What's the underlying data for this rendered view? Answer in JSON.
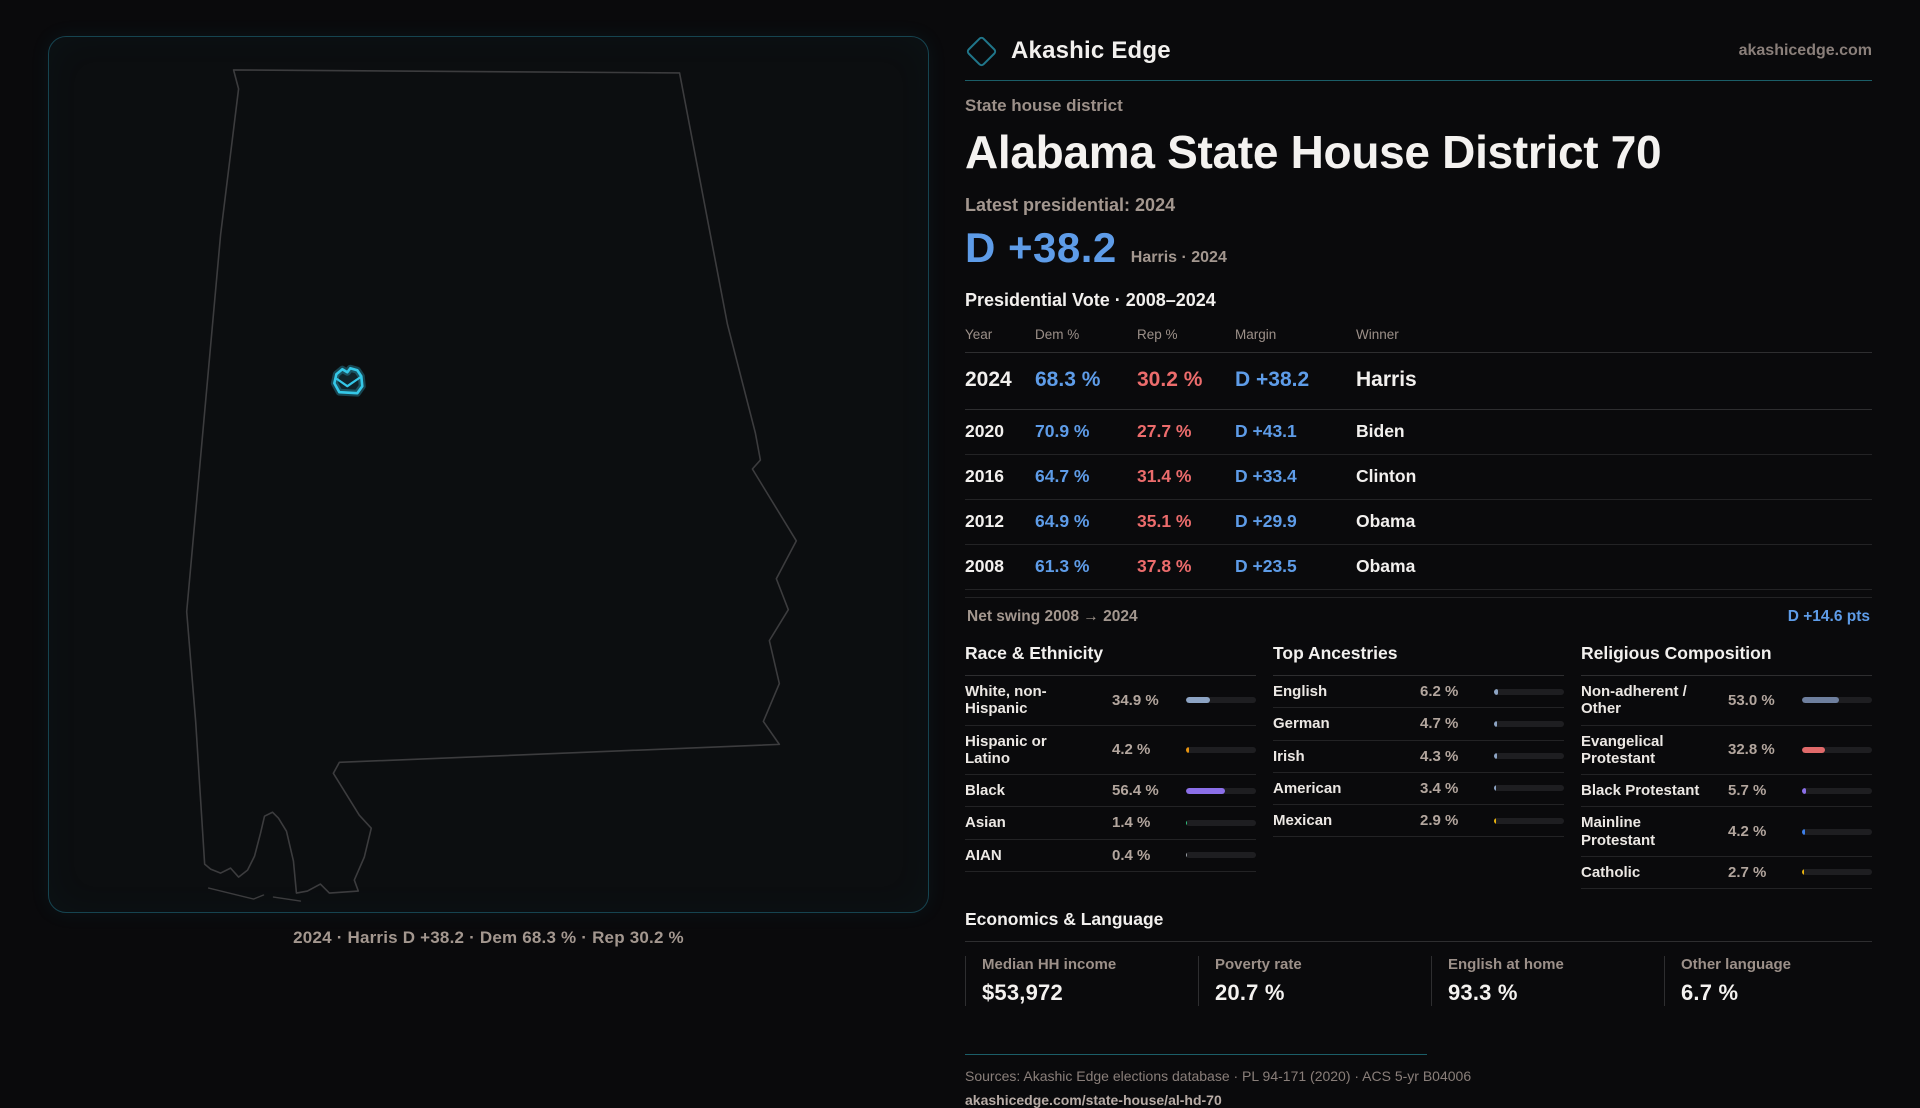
{
  "brand": {
    "name": "Akashic Edge",
    "domain": "akashicedge.com"
  },
  "page": {
    "kicker": "State house district",
    "title": "Alabama State House District 70",
    "latest_label": "Latest presidential: 2024",
    "margin_value": "D +38.2",
    "margin_detail": "Harris · 2024"
  },
  "map": {
    "caption": "2024 · Harris D +38.2 · Dem 68.3 % · Rep 30.2 %",
    "accent_color": "#35c8e8"
  },
  "pres_table": {
    "title": "Presidential Vote · 2008–2024",
    "columns": {
      "year": "Year",
      "dem": "Dem %",
      "rep": "Rep %",
      "margin": "Margin",
      "winner": "Winner"
    },
    "rows": [
      {
        "year": "2024",
        "dem": "68.3 %",
        "rep": "30.2 %",
        "margin": "D +38.2",
        "winner": "Harris"
      },
      {
        "year": "2020",
        "dem": "70.9 %",
        "rep": "27.7 %",
        "margin": "D +43.1",
        "winner": "Biden"
      },
      {
        "year": "2016",
        "dem": "64.7 %",
        "rep": "31.4 %",
        "margin": "D +33.4",
        "winner": "Clinton"
      },
      {
        "year": "2012",
        "dem": "64.9 %",
        "rep": "35.1 %",
        "margin": "D +29.9",
        "winner": "Obama"
      },
      {
        "year": "2008",
        "dem": "61.3 %",
        "rep": "37.8 %",
        "margin": "D +23.5",
        "winner": "Obama"
      }
    ],
    "net_swing_label": "Net swing 2008 → 2024",
    "net_swing_value": "D +14.6 pts"
  },
  "race": {
    "title": "Race & Ethnicity",
    "rows": [
      {
        "label": "White, non-Hispanic",
        "value": "34.9 %",
        "pct": 34.9,
        "color": "#8da4c4"
      },
      {
        "label": "Hispanic or Latino",
        "value": "4.2 %",
        "pct": 4.2,
        "color": "#e8940f"
      },
      {
        "label": "Black",
        "value": "56.4 %",
        "pct": 56.4,
        "color": "#8b6fe8"
      },
      {
        "label": "Asian",
        "value": "1.4 %",
        "pct": 1.4,
        "color": "#2ec27e"
      },
      {
        "label": "AIAN",
        "value": "0.4 %",
        "pct": 0.4,
        "color": "#9aa0a6"
      }
    ]
  },
  "ancestries": {
    "title": "Top Ancestries",
    "rows": [
      {
        "label": "English",
        "value": "6.2 %",
        "pct": 6.2,
        "color": "#8da4c4"
      },
      {
        "label": "German",
        "value": "4.7 %",
        "pct": 4.7,
        "color": "#8da4c4"
      },
      {
        "label": "Irish",
        "value": "4.3 %",
        "pct": 4.3,
        "color": "#8da4c4"
      },
      {
        "label": "American",
        "value": "3.4 %",
        "pct": 3.4,
        "color": "#8da4c4"
      },
      {
        "label": "Mexican",
        "value": "2.9 %",
        "pct": 2.9,
        "color": "#e8b20f"
      }
    ]
  },
  "religion": {
    "title": "Religious Composition",
    "rows": [
      {
        "label": "Non-adherent / Other",
        "value": "53.0 %",
        "pct": 53.0,
        "color": "#6e7f9e"
      },
      {
        "label": "Evangelical Protestant",
        "value": "32.8 %",
        "pct": 32.8,
        "color": "#e06a6a"
      },
      {
        "label": "Black Protestant",
        "value": "5.7 %",
        "pct": 5.7,
        "color": "#8b6fe8"
      },
      {
        "label": "Mainline Protestant",
        "value": "4.2 %",
        "pct": 4.2,
        "color": "#3d7fe8"
      },
      {
        "label": "Catholic",
        "value": "2.7 %",
        "pct": 2.7,
        "color": "#e8b20f"
      }
    ]
  },
  "economics": {
    "title": "Economics & Language",
    "stats": [
      {
        "label": "Median HH income",
        "value": "$53,972"
      },
      {
        "label": "Poverty rate",
        "value": "20.7 %"
      },
      {
        "label": "English at home",
        "value": "93.3 %"
      },
      {
        "label": "Other language",
        "value": "6.7 %"
      }
    ]
  },
  "footer": {
    "sources": "Sources: Akashic Edge elections database · PL 94-171 (2020) · ACS 5-yr B04006",
    "link": "akashicedge.com/state-house/al-hd-70"
  },
  "colors": {
    "dem_blue": "#5e9ce8",
    "rep_red": "#ec6c6c",
    "accent_teal": "#1b5e68",
    "district_cyan": "#35c8e8"
  }
}
